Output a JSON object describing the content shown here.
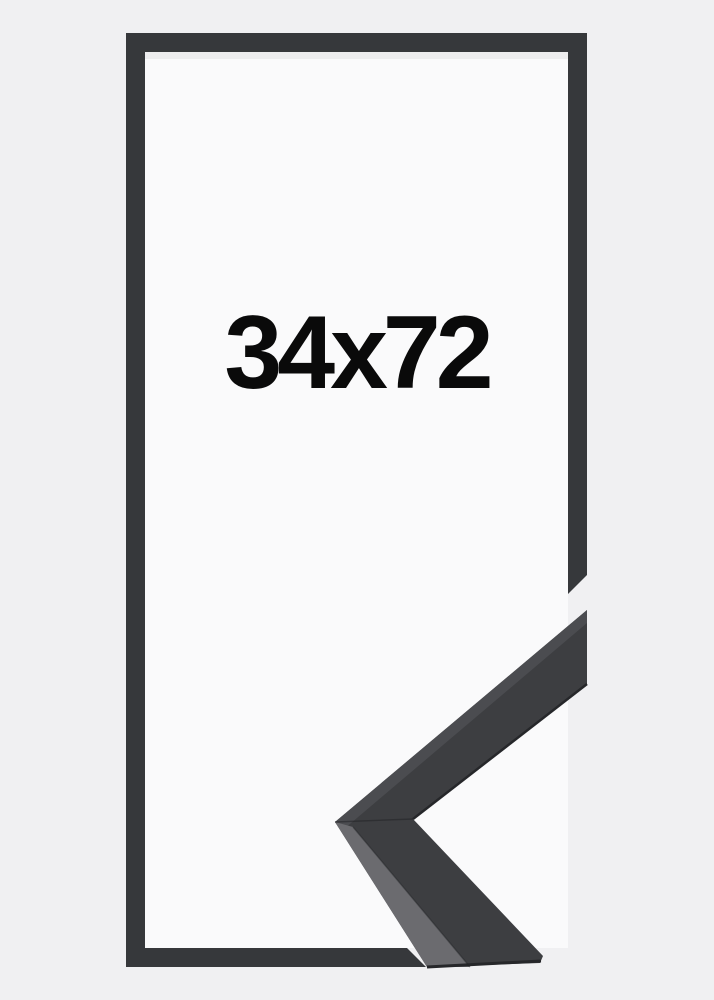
{
  "frame": {
    "size_label": "34x72",
    "label_color": "#0a0a0a",
    "colors": {
      "background": "#f0f0f2",
      "interior": "#fafafb",
      "moulding": "#36383b",
      "corner_front": "#3d3e41",
      "corner_top_face": "#4b4c50",
      "corner_side_face": "#6b6b6f",
      "corner_edge_dark": "#26272a",
      "seam_line": "#222326",
      "inner_shadow": "rgba(0,0,0,0.05)"
    }
  }
}
